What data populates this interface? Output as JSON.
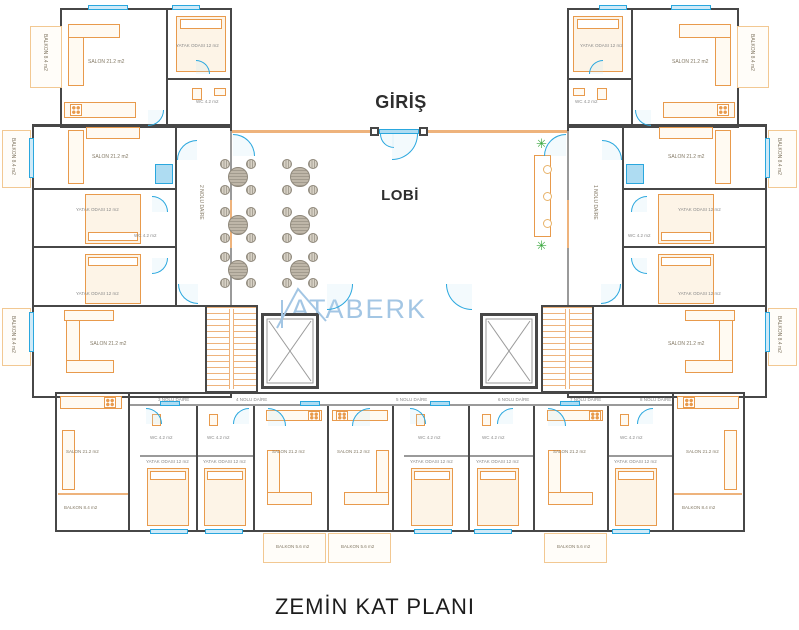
{
  "plan": {
    "entrance_label": "GİRİŞ",
    "lobby_label": "LOBİ",
    "watermark": "ATABERK",
    "title": "ZEMİN KAT PLANI"
  },
  "room_labels": {
    "salon": "SALON 21.2 m2",
    "bedroom": "YATAK ODASI 12 m2",
    "wc": "WC 4.2 m2",
    "balcony_large": "BALKON 8.4 m2",
    "balcony_small": "BALKON 5.6 m2"
  },
  "apartments": {
    "a1": "1 NOLU DAİRE",
    "a2": "2 NOLU DAİRE",
    "a3": "3 NOLU DAİRE",
    "a4": "4 NOLU DAİRE",
    "a5": "5 NOLU DAİRE",
    "a6": "6 NOLU DAİRE",
    "a7": "7 NOLU DAİRE",
    "a8": "8 NOLU DAİRE"
  },
  "icons": {
    "plant": "✳"
  },
  "colors": {
    "wall": "#474747",
    "furniture": "#e89a4c",
    "balcony_line": "#f2c892",
    "door": "#2aa7de",
    "door_fill": "#bfe3f5",
    "table": "#beb6a8",
    "plant": "#3aa83f",
    "watermark": "#a3c6e4",
    "label_text": "#847a66"
  }
}
